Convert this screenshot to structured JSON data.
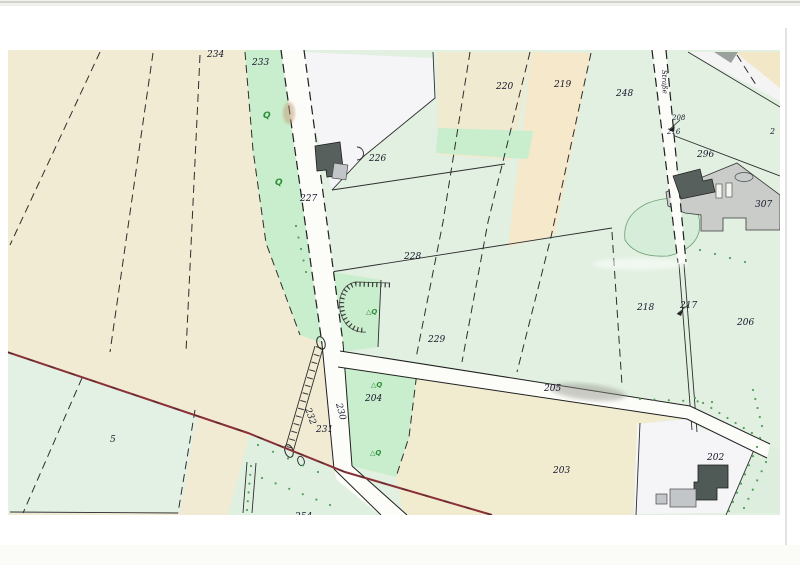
{
  "document": {
    "description": "Scanned cadastral parcel map (Flurkarte) with numbered land parcels, roads, buildings and vegetation symbols",
    "street_label": {
      "text": "Straße",
      "x": 662,
      "y": 70,
      "rotation": 88,
      "size": 7
    },
    "colors": {
      "field_beige": "#f0ebd2",
      "field_beige_warm": "#f5e8cb",
      "field_green_pale": "#e1f0e1",
      "field_green_bright": "#c9eecd",
      "parcel_white": "#f5f4f6",
      "yard_gray": "#c9ccc8",
      "building_dark": "#57605c",
      "building_light": "#c2c6c9",
      "road_white": "#fcfcf9",
      "boundary_black": "#2e2e2e",
      "municipal_red": "#8a3038",
      "symbol_green": "#2e8f3c",
      "label_ink": "#18182c"
    },
    "parcel_labels": [
      {
        "text": "234",
        "x": 207,
        "y": 57,
        "size": 9
      },
      {
        "text": "233",
        "x": 252,
        "y": 65,
        "size": 9
      },
      {
        "text": "220",
        "x": 496,
        "y": 89,
        "size": 9
      },
      {
        "text": "219",
        "x": 554,
        "y": 87,
        "size": 9
      },
      {
        "text": "248",
        "x": 616,
        "y": 96,
        "size": 9
      },
      {
        "text": "208",
        "x": 672,
        "y": 120,
        "size": 7
      },
      {
        "text": "216",
        "x": 667,
        "y": 134,
        "size": 7
      },
      {
        "text": "2",
        "x": 770,
        "y": 134,
        "size": 8
      },
      {
        "text": "296",
        "x": 697,
        "y": 157,
        "size": 9
      },
      {
        "text": "307",
        "x": 755,
        "y": 207,
        "size": 9
      },
      {
        "text": "226",
        "x": 369,
        "y": 161,
        "size": 9
      },
      {
        "text": "227",
        "x": 300,
        "y": 201,
        "size": 9
      },
      {
        "text": "228",
        "x": 404,
        "y": 259,
        "size": 9
      },
      {
        "text": "229",
        "x": 428,
        "y": 342,
        "size": 9
      },
      {
        "text": "218",
        "x": 637,
        "y": 310,
        "size": 9
      },
      {
        "text": "217",
        "x": 680,
        "y": 308,
        "size": 9
      },
      {
        "text": "206",
        "x": 737,
        "y": 325,
        "size": 9
      },
      {
        "text": "205",
        "x": 544,
        "y": 391,
        "size": 9
      },
      {
        "text": "204",
        "x": 365,
        "y": 401,
        "size": 9
      },
      {
        "text": "230",
        "x": 336,
        "y": 404,
        "size": 9,
        "rotation": 75
      },
      {
        "text": "232",
        "x": 305,
        "y": 409,
        "size": 9,
        "rotation": 70
      },
      {
        "text": "231",
        "x": 316,
        "y": 432,
        "size": 9
      },
      {
        "text": "203",
        "x": 553,
        "y": 473,
        "size": 9
      },
      {
        "text": "202",
        "x": 707,
        "y": 460,
        "size": 9
      },
      {
        "text": "5",
        "x": 110,
        "y": 442,
        "size": 9
      },
      {
        "text": "254",
        "x": 295,
        "y": 519,
        "size": 9
      }
    ],
    "vegetation_symbols": [
      {
        "type": "Q",
        "x": 263,
        "y": 118
      },
      {
        "type": "Q",
        "x": 275,
        "y": 185
      },
      {
        "type": "treeQ",
        "x": 366,
        "y": 314
      },
      {
        "type": "treeQ",
        "x": 371,
        "y": 387
      },
      {
        "type": "treeQ",
        "x": 370,
        "y": 455
      }
    ]
  }
}
